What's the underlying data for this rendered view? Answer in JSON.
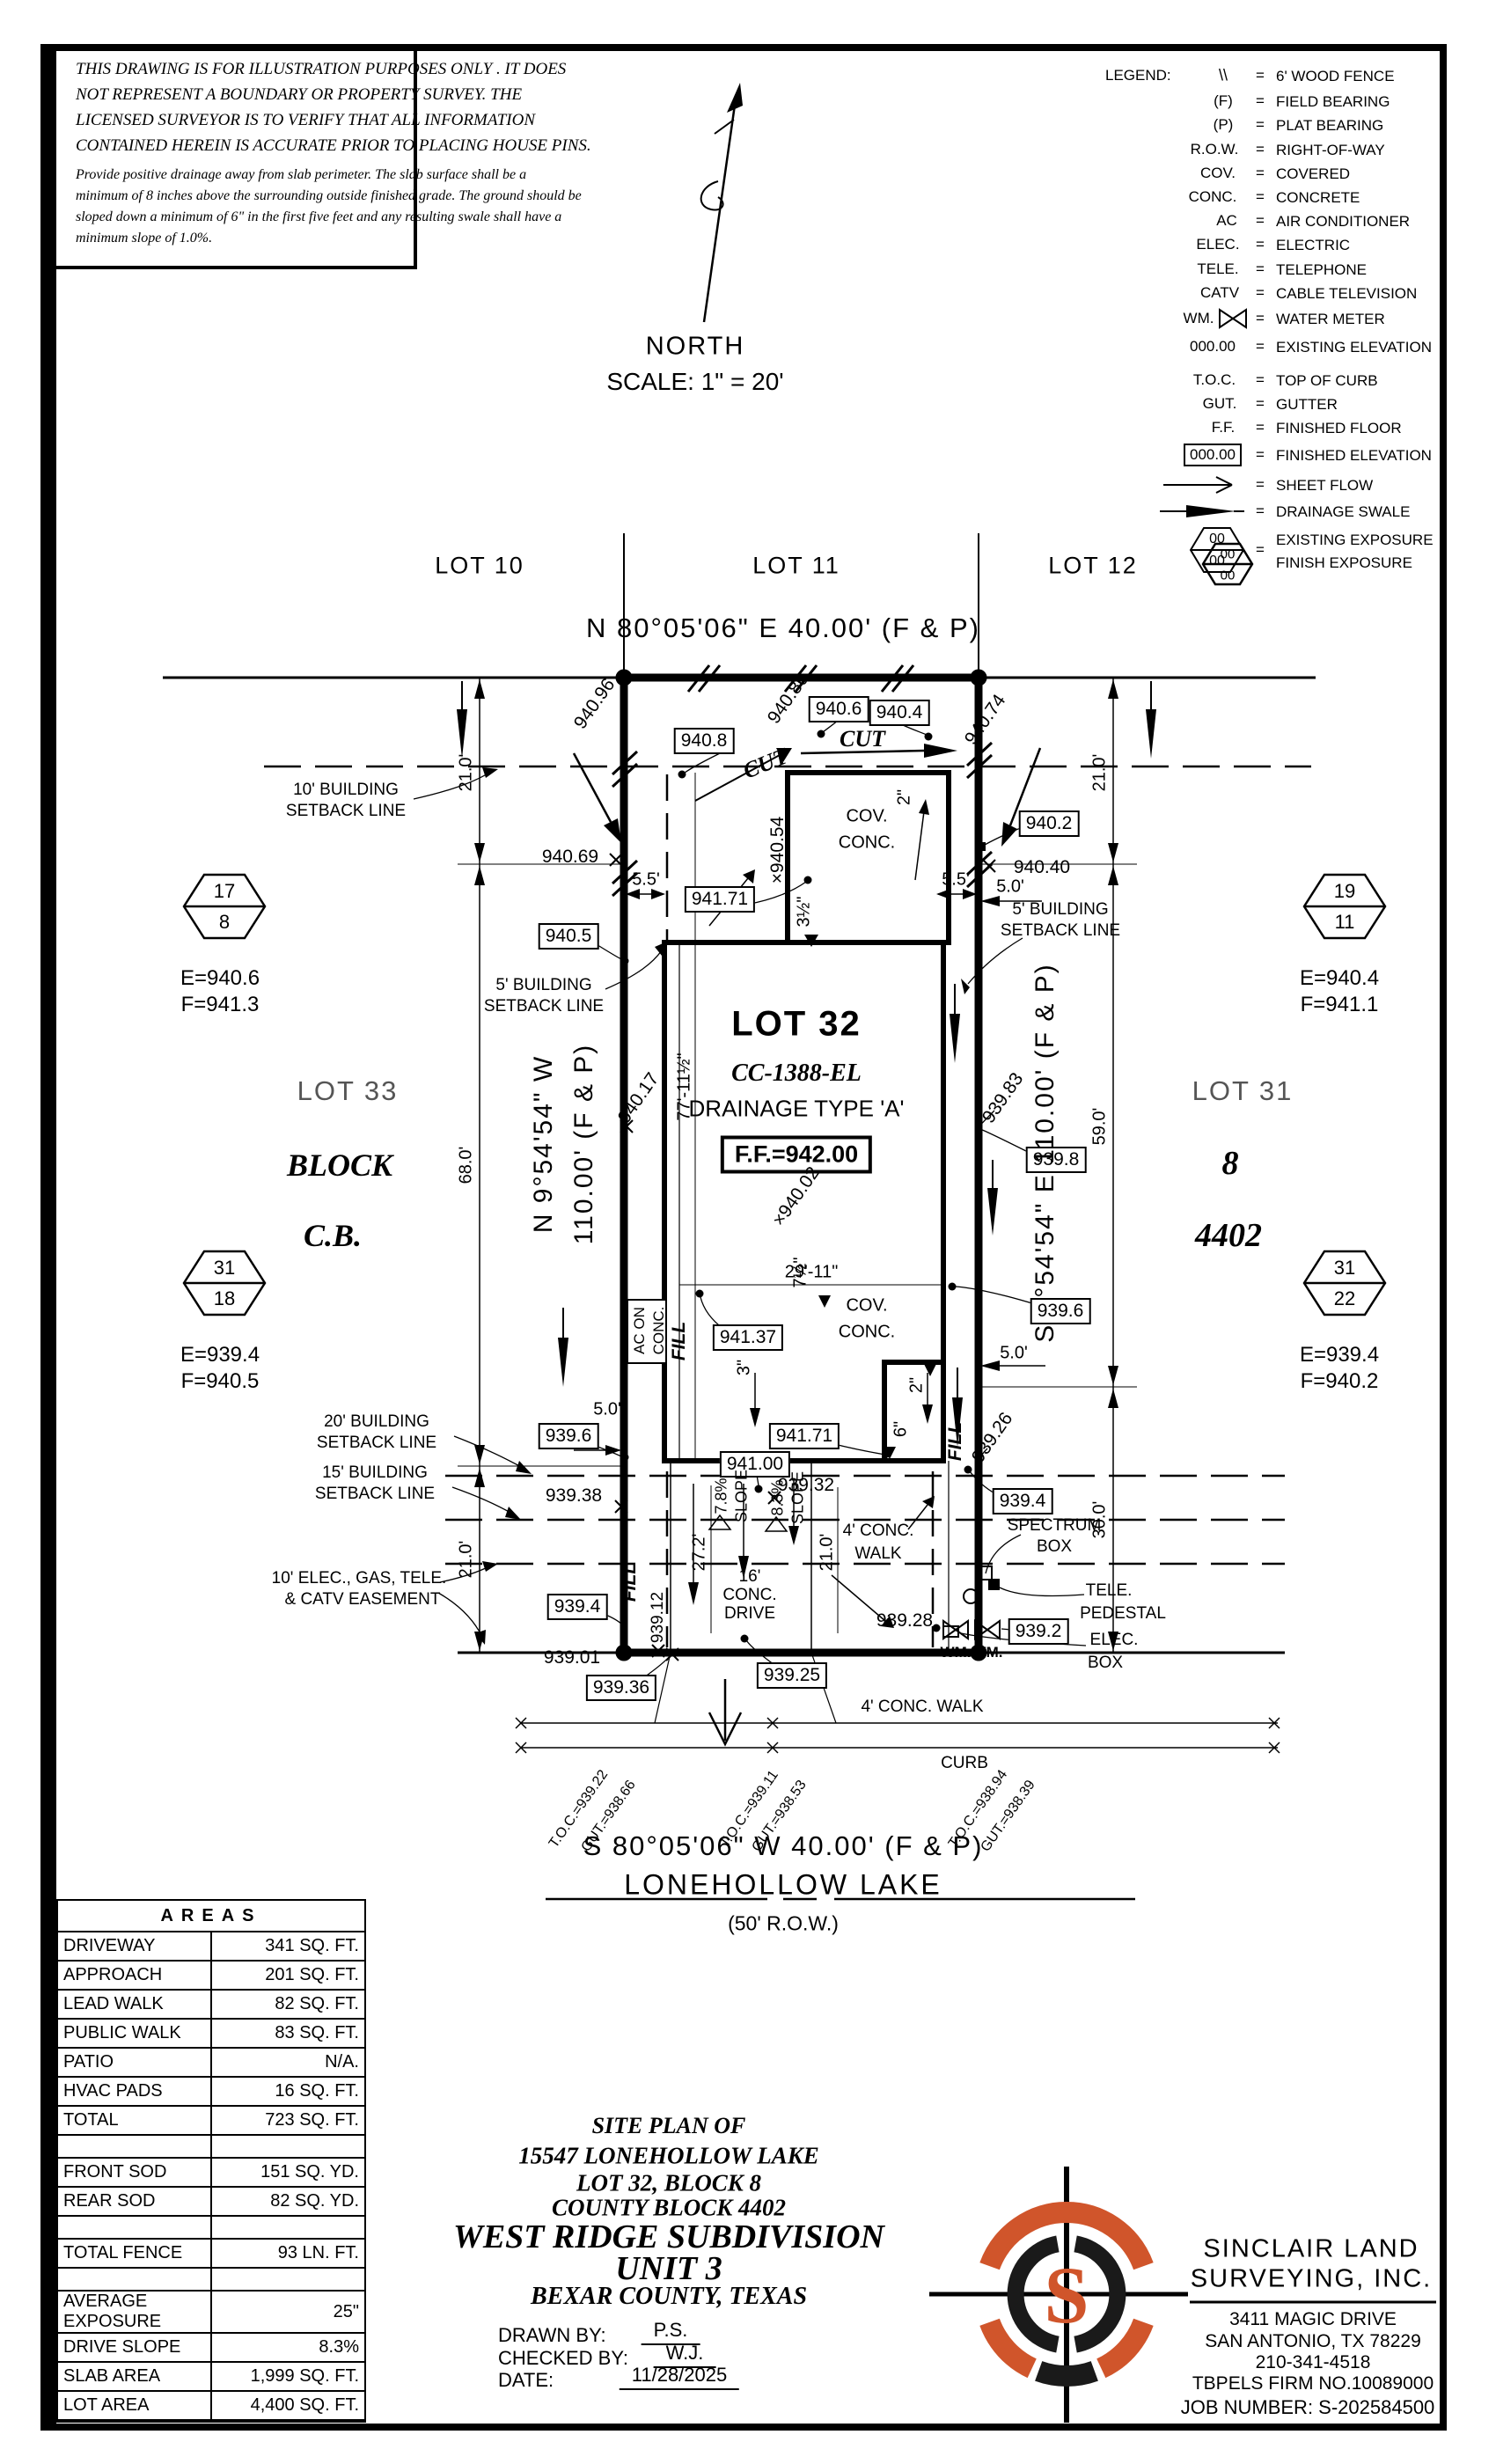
{
  "disclaimer": {
    "l1": "THIS DRAWING IS FOR ILLUSTRATION PURPOSES ONLY . IT DOES",
    "l2": "NOT REPRESENT A BOUNDARY OR PROPERTY SURVEY. THE",
    "l3": "LICENSED SURVEYOR IS TO VERIFY THAT ALL INFORMATION",
    "l4": "CONTAINED HEREIN IS ACCURATE PRIOR TO PLACING HOUSE PINS.",
    "p1": "Provide positive drainage away from slab perimeter. The slab surface shall be a",
    "p2": "minimum of 8 inches above the surrounding outside finished grade. The ground should be",
    "p3": "sloped down a minimum of 6\" in the first five feet and any resulting swale shall have a",
    "p4": "minimum slope of 1.0%."
  },
  "north": {
    "label": "NORTH",
    "scale": "SCALE: 1\" = 20'"
  },
  "legend": {
    "title": "LEGEND:",
    "eq": "=",
    "rows": [
      {
        "sym": "\\\\",
        "desc": "6' WOOD FENCE"
      },
      {
        "sym": "(F)",
        "desc": "FIELD BEARING"
      },
      {
        "sym": "(P)",
        "desc": "PLAT BEARING"
      },
      {
        "sym": "R.O.W.",
        "desc": "RIGHT-OF-WAY"
      },
      {
        "sym": "COV.",
        "desc": "COVERED"
      },
      {
        "sym": "CONC.",
        "desc": "CONCRETE"
      },
      {
        "sym": "AC",
        "desc": "AIR CONDITIONER"
      },
      {
        "sym": "ELEC.",
        "desc": "ELECTRIC"
      },
      {
        "sym": "TELE.",
        "desc": "TELEPHONE"
      },
      {
        "sym": "CATV",
        "desc": "CABLE TELEVISION"
      },
      {
        "sym": "WM.",
        "desc": "WATER METER"
      },
      {
        "sym": "000.00",
        "desc": "EXISTING ELEVATION"
      },
      {
        "sym": "T.O.C.",
        "desc": "TOP OF CURB"
      },
      {
        "sym": "GUT.",
        "desc": "GUTTER"
      },
      {
        "sym": "F.F.",
        "desc": "FINISHED FLOOR"
      },
      {
        "sym": "000.00",
        "desc": "FINISHED ELEVATION"
      },
      {
        "sym": "",
        "desc": "SHEET FLOW"
      },
      {
        "sym": "",
        "desc": "DRAINAGE SWALE"
      }
    ],
    "exposure": {
      "top": "00",
      "bottom": "00",
      "desc1": "EXISTING EXPOSURE",
      "desc2": "FINISH EXPOSURE"
    }
  },
  "lots": {
    "lot10": "LOT 10",
    "lot11": "LOT 11",
    "lot12": "LOT 12",
    "lot33": "LOT 33",
    "block_w": "BLOCK",
    "cb_w": "C.B.",
    "lot31": "LOT 31",
    "blk8": "8",
    "cb4402": "4402"
  },
  "parcel": {
    "name": "LOT 32",
    "cc": "CC-1388-EL",
    "drainage": "DRAINAGE TYPE 'A'",
    "ff": "F.F.=942.00"
  },
  "bearings": {
    "north": "N 80°05'06\" E 40.00' (F & P)",
    "south": "S 80°05'06\" W 40.00' (F & P)",
    "west1": "N 9°54'54\" W",
    "west2": "110.00' (F & P)",
    "east": "S 9°54'54\" E 110.00' (F & P)"
  },
  "street": {
    "name": "LONEHOLLOW LAKE",
    "row": "(50' R.O.W.)"
  },
  "benchmarks": [
    {
      "top": "17",
      "bottom": "8",
      "e": "E=940.6",
      "f": "F=941.3"
    },
    {
      "top": "31",
      "bottom": "18",
      "e": "E=939.4",
      "f": "F=940.5"
    },
    {
      "top": "19",
      "bottom": "11",
      "e": "E=940.4",
      "f": "F=941.1"
    },
    {
      "top": "31",
      "bottom": "22",
      "e": "E=939.4",
      "f": "F=940.2"
    },
    {
      "top": "00",
      "bottom": "00"
    }
  ],
  "labels": {
    "cut": "CUT",
    "fill": "FILL",
    "cov": "COV.",
    "conc": "CONC.",
    "ac1": "AC ON",
    "ac2": "CONC.",
    "sb10a": "10' BUILDING",
    "sb10b": "SETBACK LINE",
    "sb5a": "5' BUILDING",
    "sb5b": "SETBACK LINE",
    "sb20a": "20' BUILDING",
    "sb20b": "SETBACK LINE",
    "sb15a": "15' BUILDING",
    "sb15b": "SETBACK LINE",
    "ease1": "10' ELEC., GAS, TELE.",
    "ease2": "& CATV EASEMENT",
    "drive1": "16'",
    "drive2": "CONC.",
    "drive3": "DRIVE",
    "walk1": "4' CONC.",
    "walk2": "WALK",
    "walkfull": "4' CONC. WALK",
    "curb": "CURB",
    "spec1": "SPECTRUM",
    "spec2": "BOX",
    "tele1": "TELE.",
    "tele2": "PEDESTAL",
    "elec1": "ELEC.",
    "elec2": "BOX",
    "wm": "WM.",
    "slope1": "7.8%",
    "slope2": "8.3%",
    "slope_w": "SLOPE"
  },
  "dims": {
    "d21": "21.0'",
    "d68": "68.0'",
    "d59": "59.0'",
    "d30": "30.0'",
    "d55": "5.5'",
    "d50": "5.0'",
    "d272": "27.2'",
    "d210": "21.0'",
    "d2911": "29'-11\"",
    "d7711": "77'-11½\"",
    "in2": "2\"",
    "in3": "3\"",
    "in6": "6\"",
    "in35": "3½\"",
    "in75": "7½\""
  },
  "elev": {
    "e94096": "940.96",
    "e9408": "940.8",
    "e94086": "940.86",
    "e9406": "940.6",
    "e9404": "940.4",
    "e94074": "940.74",
    "e94069": "940.69",
    "e94054": "×940.54",
    "e9402": "940.2",
    "e94040": "940.40",
    "e94171": "941.71",
    "e9405": "940.5",
    "e94017": "940.17",
    "e94002": "×940.02",
    "e93983": "939.83",
    "e9398": "939.8",
    "e94137": "941.37",
    "e94100": "941.00",
    "e9396": "939.6",
    "e93938": "939.38",
    "e93932": "939.32",
    "e93926": "939.26",
    "e9394": "939.4",
    "e93912": "939.12",
    "e93901": "939.01",
    "e93936": "939.36",
    "e93925": "939.25",
    "e93928": "939.28",
    "e9392": "939.2"
  },
  "toc": {
    "t1": "T.O.C.=939.22",
    "g1": "GUT.=938.66",
    "t2": "T.O.C.=939.11",
    "g2": "GUT.=938.53",
    "t3": "T.O.C.=938.94",
    "g3": "GUT.=938.39"
  },
  "areas": {
    "title": "AREAS",
    "rows": [
      {
        "label": "DRIVEWAY",
        "value": "341 SQ. FT."
      },
      {
        "label": "APPROACH",
        "value": "201 SQ. FT."
      },
      {
        "label": "LEAD WALK",
        "value": "82 SQ. FT."
      },
      {
        "label": "PUBLIC WALK",
        "value": "83 SQ. FT."
      },
      {
        "label": "PATIO",
        "value": "N/A."
      },
      {
        "label": "HVAC PADS",
        "value": "16 SQ. FT."
      },
      {
        "label": "TOTAL",
        "value": "723 SQ. FT."
      },
      {
        "label": "",
        "value": ""
      },
      {
        "label": "FRONT SOD",
        "value": "151 SQ. YD."
      },
      {
        "label": "REAR SOD",
        "value": "82 SQ. YD."
      },
      {
        "label": "",
        "value": ""
      },
      {
        "label": "TOTAL FENCE",
        "value": "93 LN. FT."
      },
      {
        "label": "",
        "value": ""
      },
      {
        "label": "AVERAGE EXPOSURE",
        "value": "25\""
      },
      {
        "label": "DRIVE SLOPE",
        "value": "8.3%"
      },
      {
        "label": "SLAB AREA",
        "value": "1,999 SQ. FT."
      },
      {
        "label": "LOT AREA",
        "value": "4,400 SQ. FT."
      }
    ]
  },
  "titleblock": {
    "l1": "SITE PLAN OF",
    "l2": "15547 LONEHOLLOW LAKE",
    "l3": "LOT 32, BLOCK 8",
    "l4": "COUNTY BLOCK 4402",
    "l5": "WEST RIDGE SUBDIVISION",
    "l6": "UNIT 3",
    "l7": "BEXAR COUNTY, TEXAS",
    "drawn_label": "DRAWN BY:",
    "drawn": "P.S.",
    "checked_label": "CHECKED BY:",
    "checked": "W.J.",
    "date_label": "DATE:",
    "date": "11/28/2025"
  },
  "company": {
    "name1": "SINCLAIR LAND",
    "name2": "SURVEYING, INC.",
    "addr1": "3411 MAGIC DRIVE",
    "addr2": "SAN ANTONIO, TX 78229",
    "phone": "210-341-4518",
    "firm": "TBPELS FIRM NO.10089000",
    "job": "JOB NUMBER: S-202584500",
    "logo_letter": "S",
    "orange": "#d0552b"
  }
}
